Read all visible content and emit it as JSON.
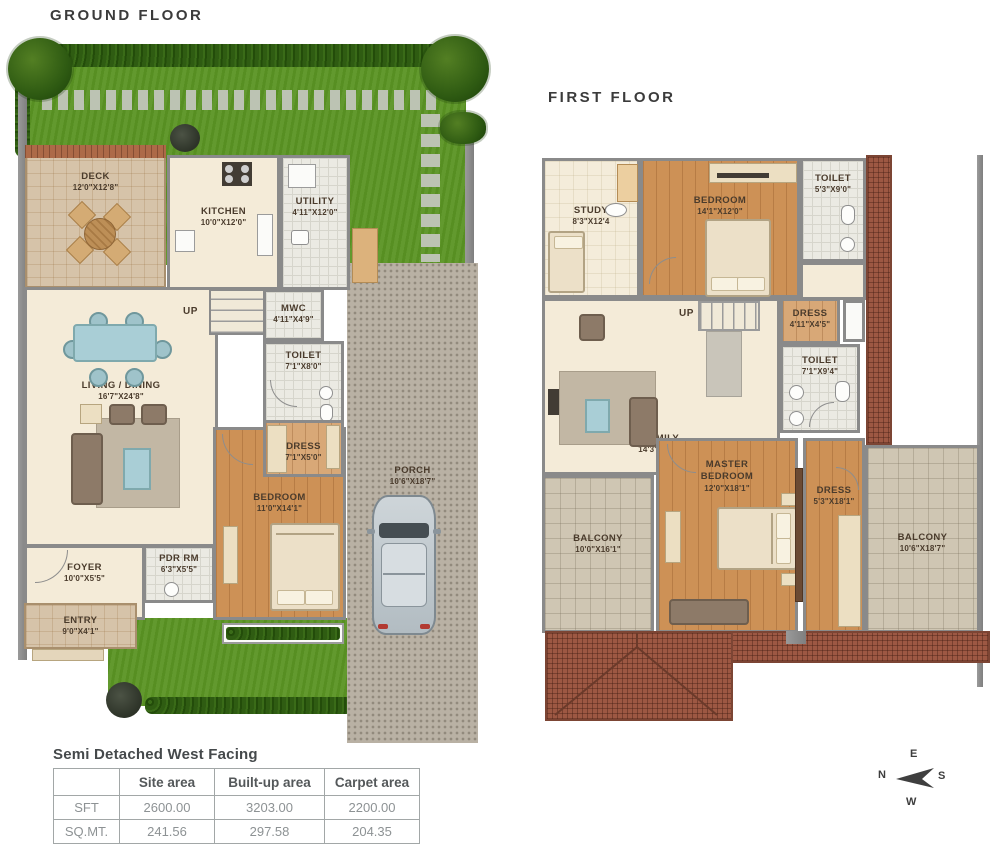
{
  "ground_floor": {
    "title": "GROUND FLOOR",
    "rooms": {
      "deck": {
        "name": "DECK",
        "dim": "12'0\"X12'8\""
      },
      "kitchen": {
        "name": "KITCHEN",
        "dim": "10'0\"X12'0\""
      },
      "utility": {
        "name": "UTILITY",
        "dim": "4'11\"X12'0\""
      },
      "mwc": {
        "name": "MWC",
        "dim": "4'11\"X4'9\""
      },
      "toilet": {
        "name": "TOILET",
        "dim": "7'1\"X8'0\""
      },
      "living_dining": {
        "name": "LIVING / DINING",
        "dim": "16'7\"X24'8\""
      },
      "dress": {
        "name": "DRESS",
        "dim": "7'1\"X5'0\""
      },
      "bedroom": {
        "name": "BEDROOM",
        "dim": "11'0\"X14'1\""
      },
      "pdr": {
        "name": "PDR RM",
        "dim": "6'3\"X5'5\""
      },
      "foyer": {
        "name": "FOYER",
        "dim": "10'0\"X5'5\""
      },
      "entry": {
        "name": "ENTRY",
        "dim": "9'0\"X4'1\""
      },
      "porch": {
        "name": "PORCH",
        "dim": "10'6\"X18'7\""
      },
      "up": "UP"
    }
  },
  "first_floor": {
    "title": "FIRST FLOOR",
    "rooms": {
      "study": {
        "name": "STUDY",
        "dim": "8'3\"X12'4"
      },
      "bedroom": {
        "name": "BEDROOM",
        "dim": "14'1\"X12'0\""
      },
      "toilet_top": {
        "name": "TOILET",
        "dim": "5'3\"X9'0\""
      },
      "dress_small": {
        "name": "DRESS",
        "dim": "4'11\"X4'5\""
      },
      "toilet_mid": {
        "name": "TOILET",
        "dim": "7'1\"X9'4\""
      },
      "family": {
        "name": "FAMILY",
        "dim": "14'3\"X16'5\""
      },
      "master_bedroom": {
        "name": "MASTER BEDROOM",
        "dim": "12'0\"X18'1\""
      },
      "dress_master": {
        "name": "DRESS",
        "dim": "5'3\"X18'1\""
      },
      "balcony_left": {
        "name": "BALCONY",
        "dim": "10'0\"X16'1\""
      },
      "balcony_right": {
        "name": "BALCONY",
        "dim": "10'6\"X18'7\""
      },
      "up": "UP"
    }
  },
  "summary": {
    "title": "Semi Detached West Facing",
    "columns": [
      "",
      "Site area",
      "Built-up area",
      "Carpet area"
    ],
    "rows": [
      {
        "label": "SFT",
        "site": "2600.00",
        "builtup": "3203.00",
        "carpet": "2200.00"
      },
      {
        "label": "SQ.MT.",
        "site": "241.56",
        "builtup": "297.58",
        "carpet": "204.35"
      }
    ]
  },
  "compass": {
    "top": "E",
    "left": "N",
    "right": "S",
    "bottom": "W"
  },
  "colors": {
    "lawn": "#5c9525",
    "hedge": "#2f5c12",
    "wall": "#8a8a8a",
    "wood_floor": "#cd9156",
    "cream_floor": "#f4ebd8",
    "roof_brick": "#9d5843",
    "porch": "#b9b1a4",
    "balcony_tile": "#cfc6b3",
    "accent_teal": "#a9ced6",
    "label_text": "#4a3b2c"
  }
}
